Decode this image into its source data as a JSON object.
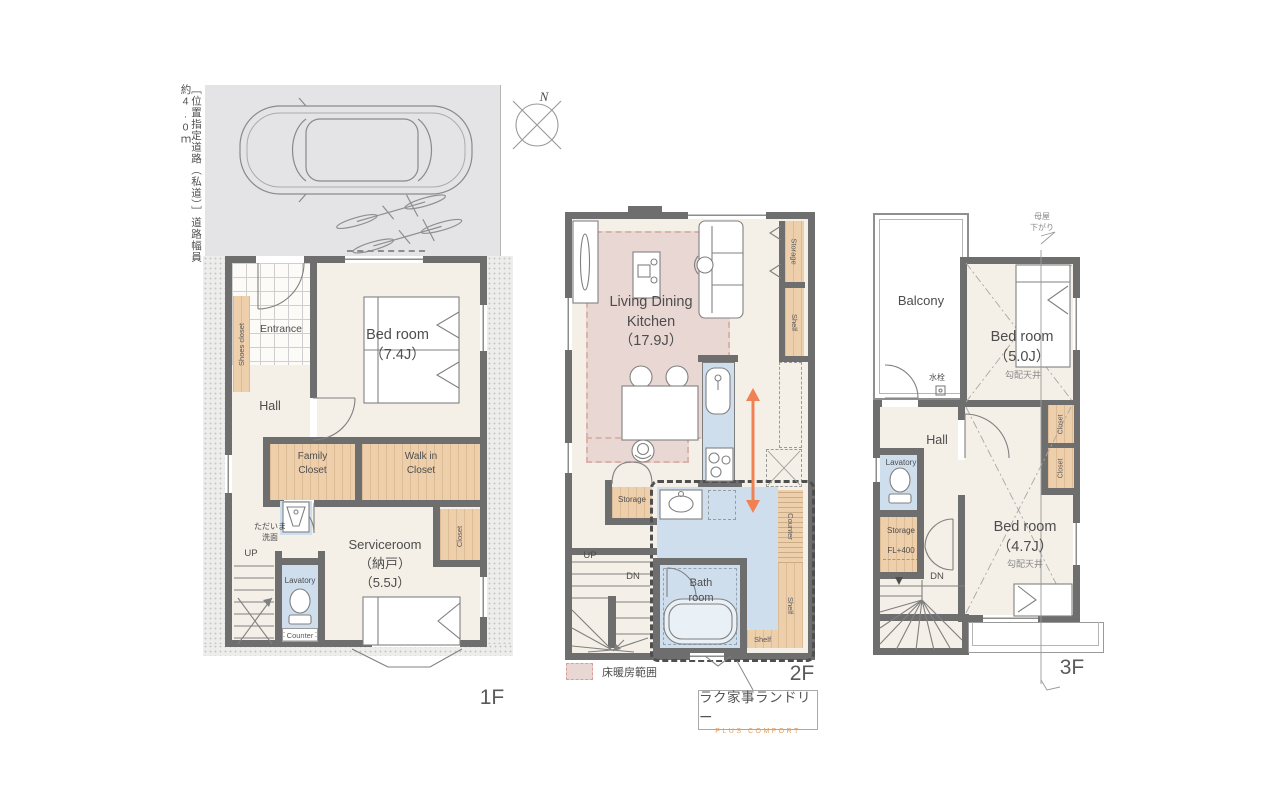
{
  "road_note": "［位置指定道路（私道）］道路幅員約4.0ｍ",
  "compass": {
    "north": "N"
  },
  "f1": {
    "floor_label": "1F",
    "shoes_closet": "Shoes closet",
    "entrance": "Entrance",
    "bedroom": "Bed room\n（7.4J）",
    "hall": "Hall",
    "family_closet": "Family\nCloset",
    "walk_in_closet": "Walk in\nCloset",
    "tadaima": "ただいま\n洗面",
    "serviceroom": "Serviceroom\n（納戸）\n（5.5J）",
    "closet": "Closet",
    "up": "UP",
    "lavatory": "Lavatory",
    "counter": "Counter"
  },
  "f2": {
    "floor_label": "2F",
    "ldk": "Living Dining\nKitchen\n（17.9J）",
    "storage_top": "Storage",
    "shelf_top": "Shelf",
    "storage_left": "Storage",
    "up": "UP",
    "dn": "DN",
    "bathroom": "Bath\nroom",
    "shelf_bottom": "Shelf",
    "shelf_side": "Shelf",
    "counter": "Counter",
    "floor_heating_legend": "床暖房範囲",
    "callout_title": "ラク家事ランドリー",
    "callout_subtitle": "PLUS COMFORT"
  },
  "f3": {
    "floor_label": "3F",
    "balcony": "Balcony",
    "faucet": "水栓",
    "bedroom_n": "Bed room\n（5.0J）",
    "sloped_ceiling_n": "勾配天井",
    "moya_sagari": "母屋\n下がり",
    "hall": "Hall",
    "lavatory": "Lavatory",
    "storage": "Storage",
    "storage_level": "FL+400",
    "dn": "DN",
    "bedroom_s": "Bed room\n（4.7J）",
    "sloped_ceiling_s": "勾配天井",
    "closet_a": "Closet",
    "closet_b": "Closet"
  },
  "colors": {
    "wall": "#6e6e6e",
    "floor": "#f4efe7",
    "floor_heating": "#e9d7d3",
    "closet": "#edcfac",
    "water": "#cfdeec",
    "driveway": "#e4e4e6",
    "arrow_orange": "#ef8153",
    "callout_accent": "#dfa067"
  }
}
